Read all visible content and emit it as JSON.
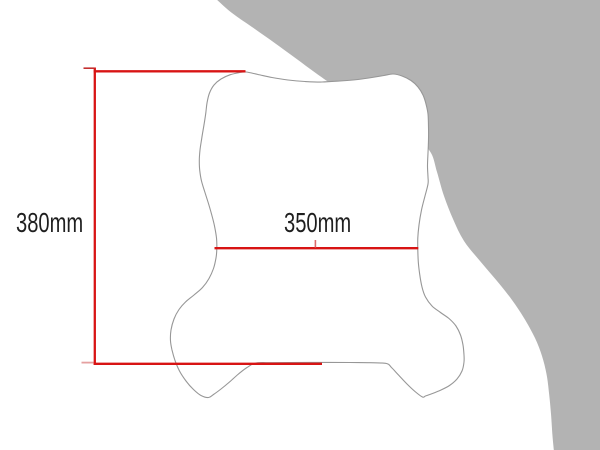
{
  "page": {
    "title": "Windscreen dimension diagram"
  },
  "colors": {
    "background": "#ffffff",
    "backdrop_gray": "#b3b3b3",
    "outline_gray": "#979797",
    "windscreen_fill": "#ffffff",
    "dimension_red": "#d81414",
    "tick_soft_red": "#e5a0a0",
    "label_text": "#1f1f1f"
  },
  "dimension_labels": {
    "height": {
      "text": "380mm",
      "x": 16,
      "y": 209
    },
    "width": {
      "text": "350mm",
      "x": 284,
      "y": 209
    }
  },
  "dimension_lines": {
    "height": [
      {
        "name": "vertical",
        "x1": 94.8,
        "y1": 67.5,
        "x2": 94.8,
        "y2": 365,
        "w": 2.3,
        "color": "#d81414"
      },
      {
        "name": "top-arm",
        "x1": 93.7,
        "y1": 71.3,
        "x2": 245.5,
        "y2": 71.3,
        "w": 2.3,
        "color": "#d81414"
      },
      {
        "name": "bottom-arm",
        "x1": 93.7,
        "y1": 363.8,
        "x2": 322,
        "y2": 363.8,
        "w": 2.3,
        "color": "#d81414"
      },
      {
        "name": "top-tick",
        "x1": 83.5,
        "y1": 68.2,
        "x2": 94.5,
        "y2": 68.2,
        "w": 1.6,
        "color": "#c43030"
      },
      {
        "name": "bottom-tick",
        "x1": 81.5,
        "y1": 362.6,
        "x2": 93.5,
        "y2": 362.6,
        "w": 1.8,
        "color": "#e5a0a0"
      }
    ],
    "width": [
      {
        "name": "main",
        "x1": 214.5,
        "y1": 248.2,
        "x2": 418.3,
        "y2": 248.2,
        "w": 2.3,
        "color": "#d81414"
      },
      {
        "name": "center-tick",
        "x1": 315.4,
        "y1": 240,
        "x2": 315.4,
        "y2": 247.5,
        "w": 1.6,
        "color": "#dd6a6a"
      }
    ]
  },
  "shapes": {
    "windscreen_outline_points": [
      [
        246,
        72
      ],
      [
        258,
        74.5
      ],
      [
        272,
        77.5
      ],
      [
        288,
        80
      ],
      [
        305,
        81.5
      ],
      [
        322,
        82
      ],
      [
        340,
        81
      ],
      [
        358,
        79.5
      ],
      [
        372,
        77.5
      ],
      [
        384,
        75.5
      ],
      [
        393,
        74
      ],
      [
        402,
        76
      ],
      [
        411,
        80.5
      ],
      [
        418,
        87
      ],
      [
        423,
        95
      ],
      [
        426,
        104
      ],
      [
        428,
        114
      ],
      [
        428.5,
        127
      ],
      [
        428.5,
        140
      ],
      [
        428,
        153
      ],
      [
        427.5,
        166
      ],
      [
        428,
        177
      ],
      [
        428,
        184
      ],
      [
        425,
        196
      ],
      [
        421.5,
        210
      ],
      [
        419,
        225
      ],
      [
        417.8,
        238
      ],
      [
        417.8,
        250
      ],
      [
        418.3,
        262
      ],
      [
        419.8,
        275
      ],
      [
        422,
        287
      ],
      [
        425.5,
        297
      ],
      [
        432,
        306
      ],
      [
        440.5,
        312.5
      ],
      [
        449,
        318.5
      ],
      [
        456,
        326
      ],
      [
        460.5,
        335
      ],
      [
        463,
        345
      ],
      [
        464,
        355
      ],
      [
        464,
        362
      ],
      [
        462,
        371
      ],
      [
        457,
        379
      ],
      [
        449.5,
        385.5
      ],
      [
        441,
        390
      ],
      [
        432.5,
        393.5
      ],
      [
        425.5,
        396
      ],
      [
        422.5,
        397
      ],
      [
        415,
        391.5
      ],
      [
        407,
        384
      ],
      [
        399,
        375.5
      ],
      [
        391.5,
        367.5
      ],
      [
        386.5,
        363.5
      ],
      [
        370,
        362.7
      ],
      [
        350,
        362.5
      ],
      [
        330,
        362.4
      ],
      [
        310,
        362.4
      ],
      [
        290,
        362.5
      ],
      [
        272,
        362.7
      ],
      [
        256,
        363
      ],
      [
        247,
        367.5
      ],
      [
        238.5,
        374
      ],
      [
        229.5,
        382
      ],
      [
        221,
        389
      ],
      [
        213.5,
        394.5
      ],
      [
        208.5,
        397.5
      ],
      [
        201,
        395.5
      ],
      [
        193.5,
        389.5
      ],
      [
        186,
        381
      ],
      [
        179.5,
        371
      ],
      [
        175,
        360.5
      ],
      [
        172,
        350
      ],
      [
        170.5,
        341
      ],
      [
        171,
        330
      ],
      [
        174,
        319
      ],
      [
        179,
        309.5
      ],
      [
        185.5,
        302
      ],
      [
        194,
        295
      ],
      [
        202.5,
        287.5
      ],
      [
        209,
        278.5
      ],
      [
        213.5,
        268.5
      ],
      [
        216,
        258
      ],
      [
        216.8,
        249
      ],
      [
        216.5,
        238
      ],
      [
        214.5,
        226
      ],
      [
        211.5,
        214
      ],
      [
        208,
        202
      ],
      [
        204.5,
        191
      ],
      [
        201.5,
        181
      ],
      [
        199.8,
        171
      ],
      [
        199.3,
        161
      ],
      [
        200,
        150
      ],
      [
        201.8,
        138
      ],
      [
        203.8,
        126
      ],
      [
        205.8,
        113
      ],
      [
        207,
        103
      ],
      [
        209.5,
        93
      ],
      [
        214,
        85
      ],
      [
        221,
        79
      ],
      [
        230,
        74.8
      ],
      [
        239,
        72.7
      ]
    ],
    "backdrop_boundary_points": [
      [
        215,
        -2
      ],
      [
        232,
        13
      ],
      [
        252,
        27
      ],
      [
        274,
        42.5
      ],
      [
        296,
        58.5
      ],
      [
        315,
        72.5
      ],
      [
        333,
        85
      ],
      [
        362,
        103
      ],
      [
        394,
        122
      ],
      [
        417,
        137
      ],
      [
        431,
        153
      ],
      [
        437,
        172
      ],
      [
        444,
        196
      ],
      [
        453,
        219
      ],
      [
        464,
        241
      ],
      [
        480,
        261
      ],
      [
        497,
        281
      ],
      [
        512,
        300
      ],
      [
        524,
        318
      ],
      [
        535,
        338
      ],
      [
        542,
        356
      ],
      [
        546.5,
        374
      ],
      [
        549,
        393
      ],
      [
        551,
        414
      ],
      [
        552.5,
        436
      ],
      [
        554,
        452
      ]
    ]
  }
}
